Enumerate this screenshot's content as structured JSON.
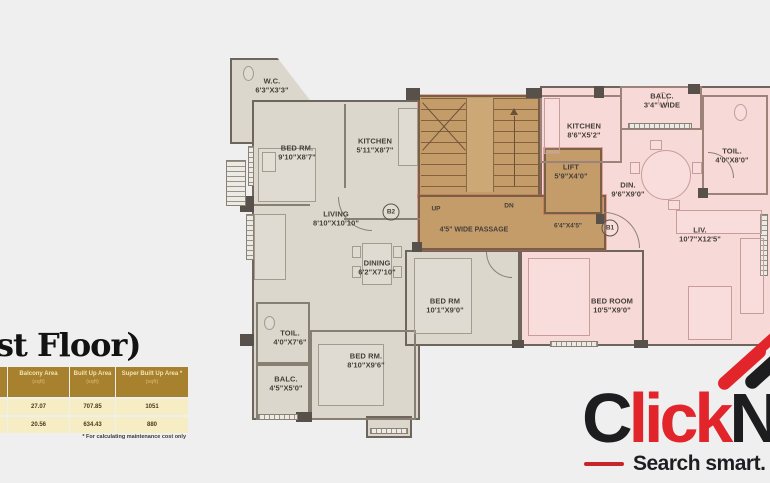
{
  "page": {
    "background": "#efefef"
  },
  "heading": {
    "text": "st Floor)"
  },
  "plan": {
    "colors": {
      "unit_b2": "#dcd7cc",
      "unit_b1": "#f7d9d8",
      "circulation": "#c49c6a"
    },
    "rooms": [
      {
        "name": "W.C.",
        "dims": "6'3\"X3'3\""
      },
      {
        "name": "BED RM.",
        "dims": "9'10\"X8'7\""
      },
      {
        "name": "KITCHEN",
        "dims": "5'11\"X8'7\""
      },
      {
        "name": "LIVING",
        "dims": "8'10\"X10'10\""
      },
      {
        "name": "DINING",
        "dims": "6'2\"X7'10\""
      },
      {
        "name": "TOIL.",
        "dims": "4'0\"X7'6\""
      },
      {
        "name": "BALC.",
        "dims": "4'5\"X5'0\""
      },
      {
        "name": "BED RM.",
        "dims": "8'10\"X9'6\""
      },
      {
        "name": "BED RM",
        "dims": "10'1\"X9'0\""
      },
      {
        "name": "BED ROOM",
        "dims": "10'5\"X9'0\""
      },
      {
        "name": "KITCHEN",
        "dims": "8'6\"X5'2\""
      },
      {
        "name": "BALC.",
        "dims": "3'4\" WIDE"
      },
      {
        "name": "TOIL.",
        "dims": "4'0\"X8'0\""
      },
      {
        "name": "DIN.",
        "dims": "9'6\"X9'0\""
      },
      {
        "name": "LIV.",
        "dims": "10'7\"X12'5\""
      },
      {
        "name": "LIFT",
        "dims": "5'9\"X4'0\""
      }
    ],
    "labels": {
      "up": "UP",
      "dn": "DN",
      "passage": "4'5\" WIDE PASSAGE",
      "lobby_dims": "6'4\"X4'5\"",
      "unit_b2": "B2",
      "unit_b1": "B1"
    }
  },
  "area_table": {
    "header_bg": "#a7812d",
    "row_bg": "#f6edc4",
    "columns": [
      {
        "title": "",
        "subtitle": ""
      },
      {
        "title": "Balcony Area",
        "subtitle": "(sqft)"
      },
      {
        "title": "Built Up Area",
        "subtitle": "(sqft)"
      },
      {
        "title": "Super Built Up Area *",
        "subtitle": "(sqft)"
      }
    ],
    "rows": [
      [
        "",
        "27.07",
        "707.85",
        "1051"
      ],
      [
        "",
        "20.56",
        "634.43",
        "880"
      ]
    ],
    "footnote": "* For calculating maintenance cost only"
  },
  "logo": {
    "word_start": "C",
    "word_mid": "lick",
    "word_end": "N",
    "tagline": "Search smart.",
    "tagline_fragment": "L",
    "red": "#e2242b",
    "black": "#1d1d1f"
  }
}
